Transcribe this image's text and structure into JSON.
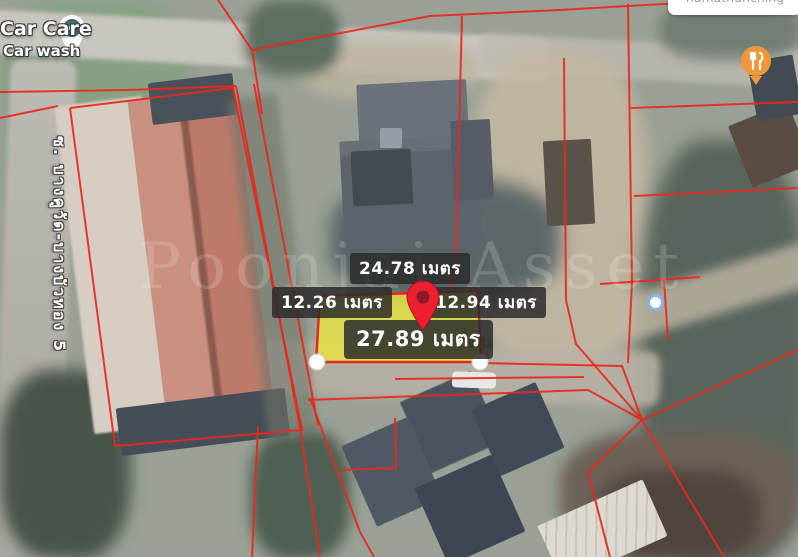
{
  "pois": {
    "car_care": {
      "title": "Car Care",
      "subtitle": "Car wash",
      "pin_icon": "teal-circle-map-pin"
    },
    "restaurant": {
      "pin_icon": "fork-and-knife-orange-pin"
    },
    "clipped_top_right_label": "namatnunching",
    "small_poi_dot_icon": "blue-ringed-dot"
  },
  "road": {
    "soi_name": "ซ. บางคูวัด-บางบัวทอง 5"
  },
  "parcel": {
    "pin_icon": "red-map-pin",
    "measurements": {
      "top": {
        "label": "24.78 เมตร",
        "value": 24.78,
        "unit": "เมตร"
      },
      "left": {
        "label": "12.26 เมตร",
        "value": 12.26,
        "unit": "เมตร"
      },
      "right": {
        "label": "12.94 เมตร",
        "value": 12.94,
        "unit": "เมตร"
      },
      "bottom": {
        "label": "27.89 เมตร",
        "value": 27.89,
        "unit": "เมตร"
      }
    }
  },
  "watermark": {
    "text": "Poonjai Asset",
    "fragment_on_parcel": "ที่ดิน"
  },
  "colors": {
    "boundary_red": "#e8281e",
    "parcel_yellow": "#ece73c",
    "pin_red": "#ee2030",
    "pin_red_core": "#8c1a28",
    "pin_teal": "#4a6572",
    "restaurant_orange": "#f0973b",
    "poi_dot_ring": "#85b4e6",
    "label_bg": "#2b2b2b",
    "label_text": "#ffffff"
  }
}
